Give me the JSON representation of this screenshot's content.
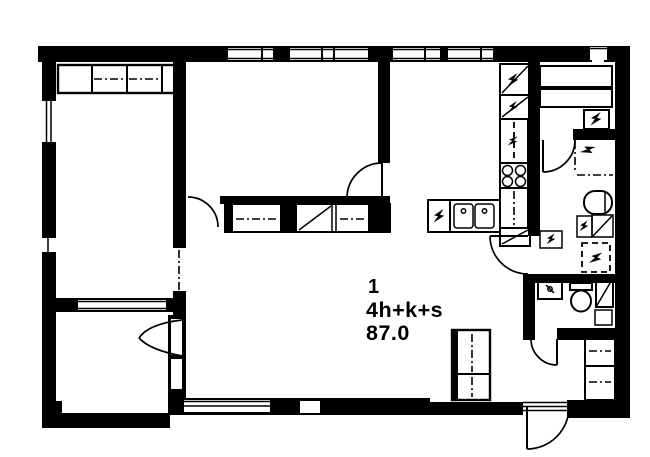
{
  "canvas": {
    "width": 650,
    "height": 457,
    "background": "#ffffff",
    "ink": "#000000"
  },
  "labels": {
    "apartment_number": "1",
    "apartment_type": "4h+k+s",
    "area_m2": "87.0"
  },
  "features": [
    "wardrobe-dashdot-icon",
    "wardrobe-diagonal-icon",
    "window-double-line-icon",
    "door-swing-arc-icon",
    "balcony-fan-door-icon",
    "doorway-dashdot-icon",
    "fridge-freezer-diagonal-bolt-icon",
    "dishwasher-bolt-icon",
    "stove-four-burners-icon",
    "kitchen-double-sink-icon",
    "sauna-benches-icon",
    "sauna-heater-bolt-icon",
    "shower-dashdot-icon",
    "washing-machine-reservation-dashed-icon",
    "washbasin-icon",
    "toilet-icon",
    "duct-diagonal-icon",
    "entrance-threshold-icon",
    "vent-box-icon"
  ]
}
